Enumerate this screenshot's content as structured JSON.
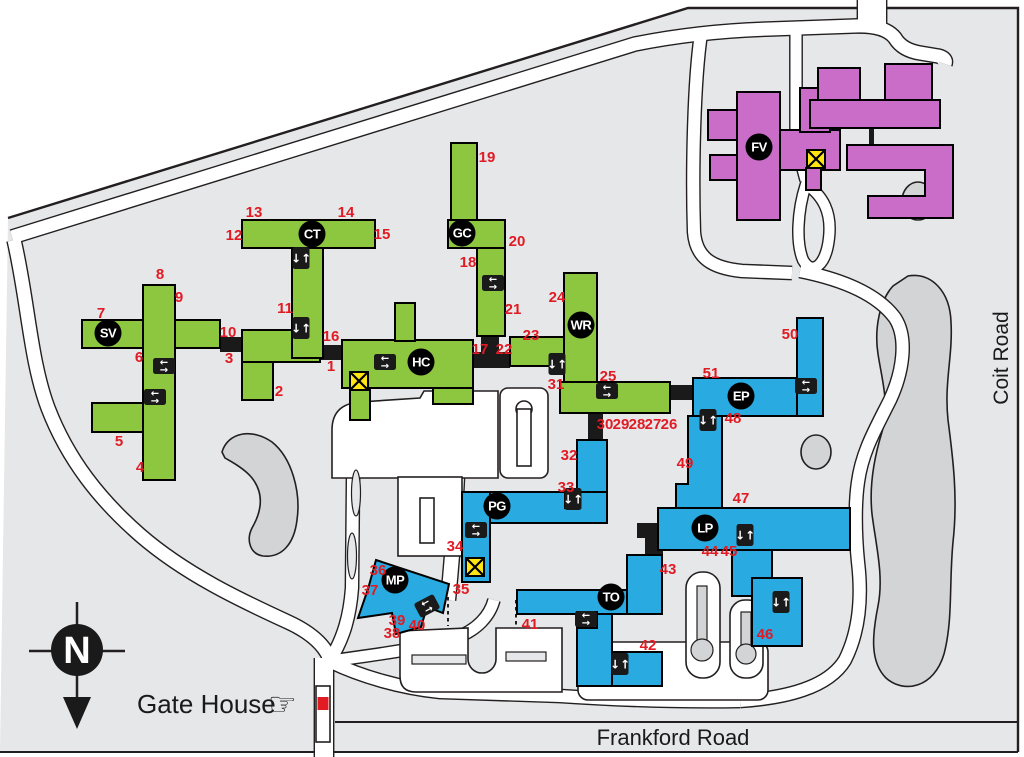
{
  "map": {
    "colors": {
      "campus": "#e6e7e8",
      "pond": "#d2d4d5",
      "road": "#ffffff",
      "outline": "#231f20",
      "green": "#8dc63f",
      "blue": "#29abe2",
      "purple": "#c96dc9",
      "yellow": "#ffe512",
      "red": "#e01b24",
      "badge": "#000000"
    },
    "road_labels": {
      "coit": "Coit Road",
      "frankford": "Frankford Road"
    },
    "gate_house_label": "Gate House",
    "compass_letter": "N",
    "buildings": [
      [
        "SV",
        108,
        333
      ],
      [
        "CT",
        312,
        234
      ],
      [
        "GC",
        462,
        233
      ],
      [
        "HC",
        421,
        362
      ],
      [
        "WR",
        581,
        325
      ],
      [
        "EP",
        741,
        396
      ],
      [
        "FV",
        759,
        147
      ],
      [
        "PG",
        497,
        506
      ],
      [
        "LP",
        705,
        528
      ],
      [
        "MP",
        395,
        580
      ],
      [
        "TO",
        611,
        597
      ]
    ],
    "entrances": [
      [
        1,
        331,
        366
      ],
      [
        2,
        279,
        391
      ],
      [
        3,
        229,
        358
      ],
      [
        4,
        140,
        467
      ],
      [
        5,
        119,
        441
      ],
      [
        6,
        139,
        357
      ],
      [
        7,
        101,
        313
      ],
      [
        8,
        160,
        274
      ],
      [
        9,
        179,
        297
      ],
      [
        10,
        228,
        332
      ],
      [
        11,
        285,
        308
      ],
      [
        12,
        234,
        235
      ],
      [
        13,
        254,
        212
      ],
      [
        14,
        346,
        212
      ],
      [
        15,
        382,
        234
      ],
      [
        16,
        331,
        336
      ],
      [
        17,
        480,
        349
      ],
      [
        18,
        468,
        262
      ],
      [
        19,
        487,
        157
      ],
      [
        20,
        517,
        241
      ],
      [
        21,
        513,
        309
      ],
      [
        22,
        504,
        349
      ],
      [
        23,
        531,
        335
      ],
      [
        24,
        557,
        297
      ],
      [
        25,
        608,
        376
      ],
      [
        26,
        669,
        424
      ],
      [
        27,
        653,
        424
      ],
      [
        28,
        637,
        424
      ],
      [
        29,
        621,
        424
      ],
      [
        30,
        605,
        424
      ],
      [
        31,
        556,
        384
      ],
      [
        32,
        569,
        455
      ],
      [
        33,
        566,
        487
      ],
      [
        34,
        455,
        546
      ],
      [
        35,
        461,
        589
      ],
      [
        36,
        378,
        570
      ],
      [
        37,
        370,
        590
      ],
      [
        38,
        392,
        633
      ],
      [
        39,
        397,
        620
      ],
      [
        40,
        417,
        625
      ],
      [
        41,
        530,
        624
      ],
      [
        42,
        648,
        645
      ],
      [
        43,
        668,
        569
      ],
      [
        44,
        710,
        551
      ],
      [
        45,
        729,
        551
      ],
      [
        46,
        765,
        634
      ],
      [
        47,
        741,
        498
      ],
      [
        48,
        733,
        418
      ],
      [
        49,
        685,
        463
      ],
      [
        50,
        790,
        334
      ],
      [
        51,
        711,
        373
      ]
    ],
    "icons": {
      "stairs": [
        [
          301,
          258
        ],
        [
          301,
          328
        ],
        [
          557,
          364
        ],
        [
          708,
          420
        ],
        [
          573,
          499
        ],
        [
          745,
          535
        ],
        [
          781,
          602
        ],
        [
          620,
          664
        ]
      ],
      "transfer": [
        [
          164,
          366,
          0
        ],
        [
          155,
          397,
          0
        ],
        [
          385,
          362,
          0
        ],
        [
          493,
          283,
          0
        ],
        [
          607,
          391,
          0
        ],
        [
          806,
          386,
          0
        ],
        [
          476,
          530,
          0
        ],
        [
          427,
          606,
          -28
        ],
        [
          586,
          619,
          0
        ]
      ],
      "elevator": [
        [
          359,
          381
        ],
        [
          475,
          567
        ],
        [
          816,
          159
        ]
      ]
    }
  }
}
